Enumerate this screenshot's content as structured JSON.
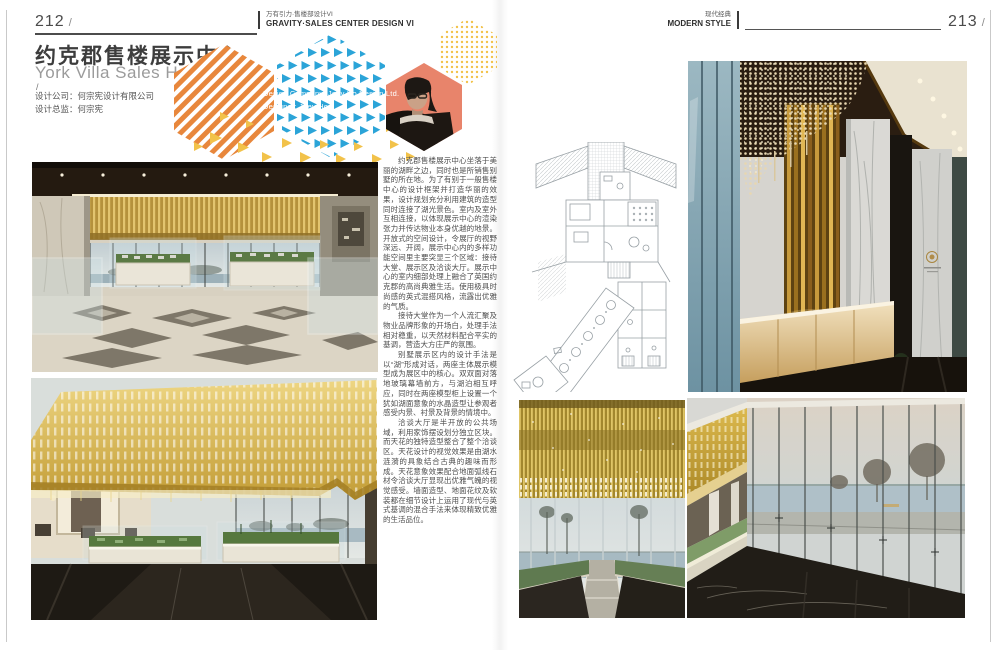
{
  "left_page": {
    "page_number": "212",
    "page_slash": "/",
    "series_header": {
      "line1_cn": "万有引力·售楼部设计VI",
      "line2_en": "GRAVITY·SALES CENTER DESIGN VI"
    },
    "title_cn": "约克郡售楼展示中心",
    "title_en": "York Villa Sales Hall",
    "credit_slash": "/",
    "credit_company": "设计公司：何宗宪设计有限公司",
    "credit_director": "设计总监：何宗宪",
    "overlay_credit_company": "Design Company: Joey Ho Design Ltd.",
    "overlay_credit_designer": "Designer: Joey Ho",
    "body": {
      "p1": "约克郡售楼展示中心坐落于美丽的湖畔之边，同时也是所销售别墅的所在地。为了有别于一般售楼中心的设计框架并打造华丽的效果，设计规划充分利用建筑的造型同时连接了湖光景色。室内及室外互相连接，以体现展示中心的渲染张力并传达物业本身优越的地景。开放式的空间设计，令展厅的视野深远、开阔，展示中心内的多样功能空间里主要突显三个区域：接待大堂、展示区及洽谈大厅。展示中心的室内细部处理上融合了英国约克郡的高尚典雅生活。使用极具时尚感的英式混搭风格，流露出优雅的气质。",
      "p2": "接待大堂作为一个人流汇聚及物业品牌形象的开场白，处理手法相对稳重，以天然材料配合平实的基调，营造大方庄严的氛围。",
      "p3": "别墅展示区内的设计手法是以“湖”形成对话，两座主体展示模型成为展区中的核心。双双面对落地玻璃幕墙前方，与湖泊相互呼应，同时在两座模型柜上设置一个犹如湖面意象的水晶造型让参观者感受内景、衬景及背景的情境中。",
      "p4": "洽谈大厅是半开放的公共场域，利用家饰摆设划分独立区块。而天花的独特造型整合了整个洽谈区。天花设计的视觉效果是由湖水涟漪的具象结合古典的趣味而形成。天花意象效果配合地面弧线石材令洽谈大厅显现出优雅气魄的视觉感受。墙面造型、地面花纹及软装都在细节设计上运用了现代与英式基调的混合手法来体现精致优雅的生活品位。"
    }
  },
  "right_page": {
    "page_number": "213",
    "page_slash": "/",
    "category_header": {
      "line1_cn": "现代经典",
      "line2_en": "MODERN STYLE"
    }
  },
  "figures": {
    "floor_plan": "ground-floor-plan-line-drawing",
    "photo_display_hall": "model-display-hall-with-gold-slat-ceiling-and-lake-view",
    "photo_gold_canopy": "golden-perforated-canopy-over-site-models",
    "photo_gold_ceiling_lake": "gold-fringe-ceiling-with-lake-window",
    "photo_reception": "reception-hall-with-crystal-chandelier-and-marble-columns",
    "photo_glass_corridor": "glass-curtain-wall-corridor-with-lake-view",
    "portrait": "designer-portrait-joey-ho"
  },
  "colors": {
    "accent_orange": "#E8873C",
    "accent_blue": "#2BA4D8",
    "accent_yellow": "#F2C24A",
    "accent_coral": "#E8846B",
    "header_text": "#3C3C3C",
    "muted_text": "#9B9B9B",
    "body_text": "#4E4E4E",
    "gold": "#C9A23E"
  }
}
